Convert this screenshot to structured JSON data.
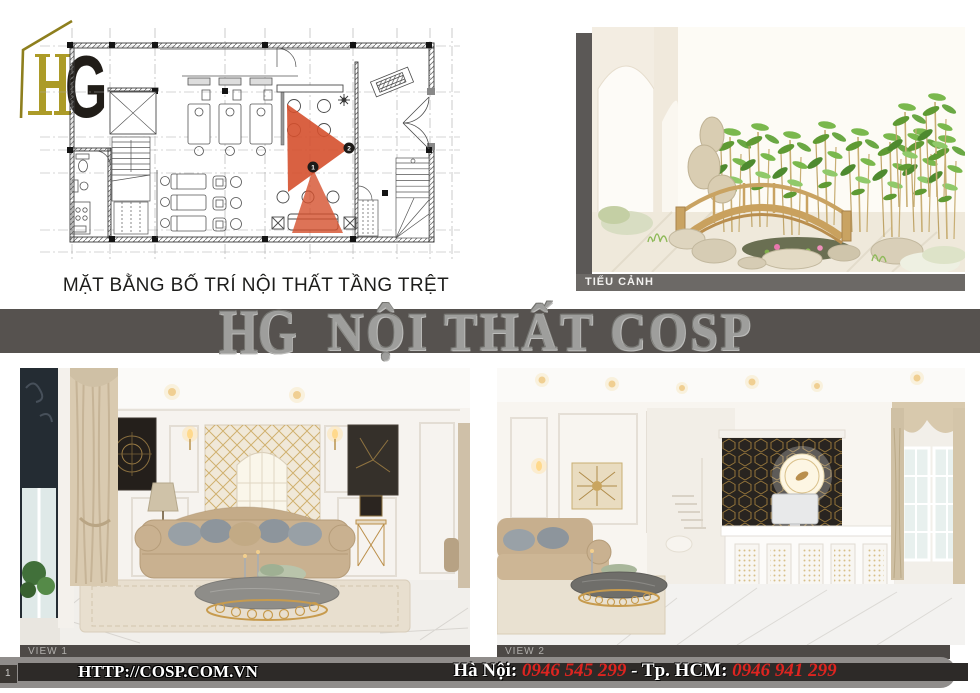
{
  "page": {
    "number": "1"
  },
  "logo": {
    "h": "H",
    "g": "G"
  },
  "floor_plan": {
    "caption": "MẶT BẰNG BỐ TRÍ NỘI THẤT TẦNG TRỆT",
    "camera_1": "1",
    "camera_2": "2"
  },
  "panels": {
    "garden_label": "TIỂU CẢNH",
    "view1_label": "VIEW 1",
    "view2_label": "VIEW 2"
  },
  "watermark": {
    "brand": "HG",
    "text": "NỘI THẤT COSP"
  },
  "footer": {
    "website": "HTTP://COSP.COM.VN",
    "hanoi_label": "Hà Nội:",
    "hanoi_phone": "0946 545 299",
    "separator": "-",
    "hcm_label": "Tp. HCM:",
    "hcm_phone": "0946 941 299",
    "page_number": "1"
  },
  "colors": {
    "accent_gold": "#ac9b28",
    "cone_red": "#d5502d",
    "phone_red": "#dd2420",
    "banner_gray": "#56524f",
    "label_gray": "#6c6966",
    "view_bar_gray": "#4d4946",
    "footer_stripe": "#2d2a28"
  }
}
